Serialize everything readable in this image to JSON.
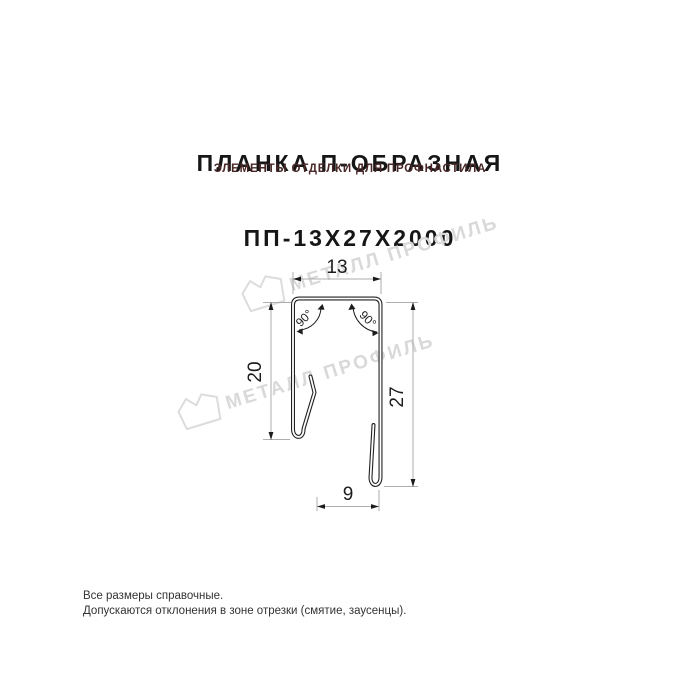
{
  "title": {
    "line1": "ПЛАНКА П-ОБРАЗНАЯ",
    "line2": "ПП-13Х27Х2000",
    "subtitle": "ЭЛЕМЕНТЫ ОТДЕЛКИ ДЛЯ ПРОФНАСТИЛА"
  },
  "drawing": {
    "kind": "technical-profile-cross-section",
    "product_code": "ПП-13Х27Х2000",
    "dimensions": {
      "top_width": "13",
      "left_height": "20",
      "right_height": "27",
      "bottom_width": "9",
      "angle_left": "90°",
      "angle_right": "90°"
    }
  },
  "watermark": {
    "text": "МЕТАЛЛ ПРОФИЛЬ"
  },
  "footer": {
    "line1": "Все размеры справочные.",
    "line2": "Допускаются отклонения в зоне отрезки (смятие, заусенцы)."
  },
  "colors": {
    "title": "#161616",
    "subtitle_accent": "#4a2828",
    "profile_line": "#222222",
    "dimension_line": "#aeaeae",
    "dimension_text": "#1c1c1c",
    "watermark": "#d9d9d9",
    "footer_text": "#333333",
    "background": "#ffffff"
  }
}
